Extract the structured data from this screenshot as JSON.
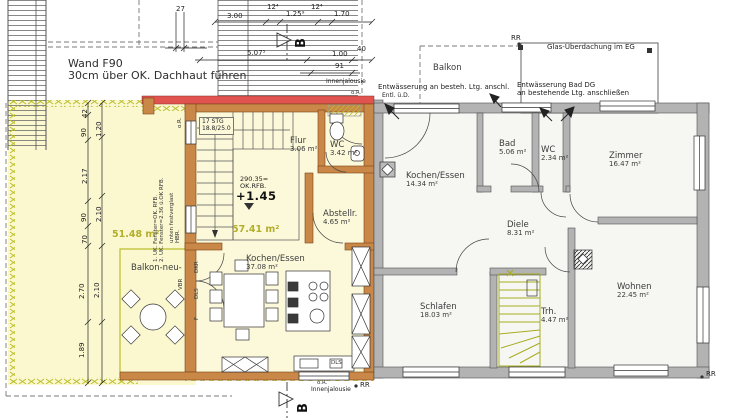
{
  "title": "Grundriss Obergeschoss — Anbau und Bestand",
  "colors": {
    "wall_new": "#c98748",
    "wall_old": "#b3b3b3",
    "firewall_red": "#e0534f",
    "terrace_fill": "#fbf8d0",
    "interior_new_fill": "#fcf9da",
    "interior_old_fill": "#f6f6f3",
    "stair_yellow": "#a8ad1f",
    "area_text": "#b3ae2b"
  },
  "notes": {
    "wand1": "Wand F90",
    "wand2": "30cm über OK. Dachhaut führen",
    "glas": "Glas-Überdachung im EG",
    "entw_l1": "Entwässerung an besteh. Ltg. anschl.",
    "entw_l2": "Entl. ü.D.",
    "entw_r1": "Entwässerung Bad DG",
    "entw_r2": "an bestehende Ltg. anschließen",
    "innenjalousie": "Innenjalousie",
    "or": "o.R.",
    "rr": "RR",
    "stg1": "17 STG",
    "stg2": "18.8/25.0",
    "level1": "290.35=",
    "level2": "OK.RFB.",
    "level3": "+1.45",
    "win1": "1. UK. Fenster=OK. RFB.",
    "win2": "2. UK. Fenster=2.36 ü.OK RFB.",
    "fest": "unten festverglast",
    "hbr": "HBR.",
    "vbr": "VBR",
    "dkr": "DKR",
    "dls": "DLS",
    "f": "F",
    "section": "B"
  },
  "rooms": {
    "balkon_alt": {
      "name": "Balkon"
    },
    "kochen_neu": {
      "name": "Kochen/Essen",
      "area": "37.08 m²"
    },
    "flur": {
      "name": "Flur",
      "area": "3.06 m²"
    },
    "wc_neu": {
      "name": "WC",
      "area": "3.42 m²"
    },
    "abstell": {
      "name": "Abstellr.",
      "area": "4.65 m²"
    },
    "balkon_neu": {
      "name": "Balkon-neu-"
    },
    "kochen_alt": {
      "name": "Kochen/Essen",
      "area": "14.34 m²"
    },
    "bad": {
      "name": "Bad",
      "area": "5.06 m²"
    },
    "wc_alt": {
      "name": "WC",
      "area": "2.34 m²"
    },
    "zimmer": {
      "name": "Zimmer",
      "area": "16.47 m²"
    },
    "diele": {
      "name": "Diele",
      "area": "8.31 m²"
    },
    "schlafen": {
      "name": "Schlafen",
      "area": "18.03 m²"
    },
    "trh": {
      "name": "Trh.",
      "area": "4.47 m²"
    },
    "wohnen": {
      "name": "Wohnen",
      "area": "22.45 m²"
    }
  },
  "areas": {
    "terrasse": "51.48 m²",
    "wohnung_neu": "57.41 m²"
  },
  "dims": {
    "d27": "27",
    "d3_00": "3.00",
    "d12a": "12⁴",
    "d1_25": "1.25⁹",
    "d12b": "12⁴",
    "d1_70": "1.70",
    "d5_07": "5.07⁵",
    "d1_00": "1.00",
    "d40": "40",
    "d91": "91",
    "d42": "42",
    "d90a": "90",
    "d1_20": "1.20",
    "d2_17": "2.17",
    "d90b": "90",
    "d2_10a": "2.10",
    "d70": "70",
    "d2_70": "2.70",
    "d2_10b": "2.10",
    "d1_89": "1.89"
  }
}
